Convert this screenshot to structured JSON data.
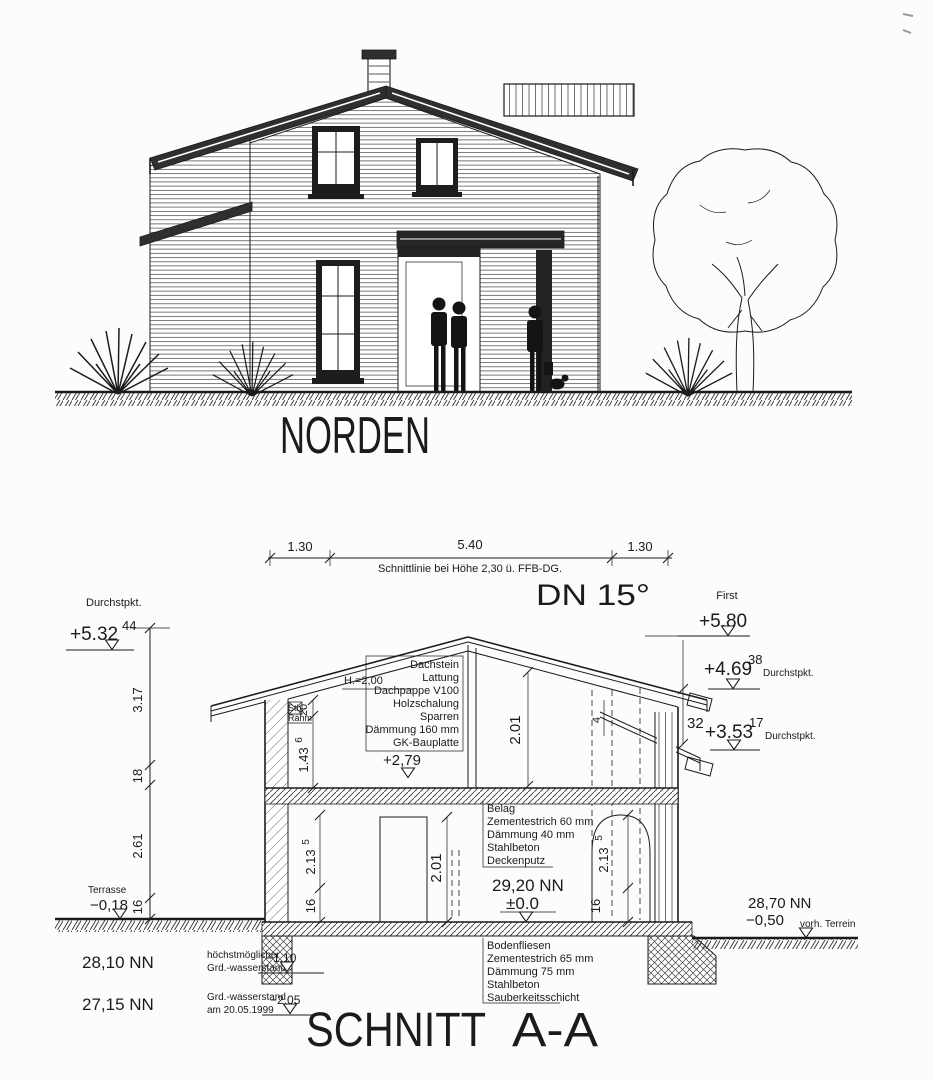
{
  "colors": {
    "ink": "#1b1b1b",
    "paper": "#fcfcfa",
    "roof_dark": "#2f2f2f"
  },
  "elevation": {
    "title": "NORDEN"
  },
  "section": {
    "title_main": "SCHNITT",
    "title_suffix": "A-A",
    "pitch": "DN 15°",
    "top_dims": {
      "left": "1.30",
      "mid": "5.40",
      "right": "1.30",
      "note": "Schnittlinie bei Höhe 2,30 ü. FFB-DG."
    },
    "levels": {
      "left_label": "Durchstpkt.",
      "left_value": "+5.32",
      "left_sup": "44",
      "first_label": "First",
      "first_value": "+5.80",
      "right1_value": "+4.69",
      "right1_sup": "38",
      "right1_label": "Durchstpkt.",
      "right_gap": "32",
      "right2_value": "+3.53",
      "right2_sup": "17",
      "right2_label": "Durchstpkt.",
      "attic": "+2,79",
      "ground_nn": "29,20 NN",
      "ground_rel": "±0.0",
      "terrace_label": "Terrasse",
      "terrace_value": "−0,18",
      "terrain_nn": "28,70 NN",
      "terrain_value": "−0,50",
      "terrain_note": "vorh. Terrein",
      "gw1_nn": "28,10 NN",
      "gw1_line1": "höchstmöglicher",
      "gw1_line2": "Grd.-wasserstand",
      "gw1_value": "−1,10",
      "gw2_nn": "27,15 NN",
      "gw2_line1": "Grd.-wasserstand",
      "gw2_line2": "am 20.05.1999",
      "gw2_value": "−2,05"
    },
    "vdims": {
      "total_upper": "3.17",
      "slab18": "18",
      "ground_floor": "2.61",
      "plinth16": "16",
      "knee_beam": "20",
      "knee_height": "1.43",
      "knee_height_sup": "6",
      "beam_label1": "Stb.-",
      "beam_label2": "Rähm",
      "attic_note": "H.=2,00",
      "attic_height": "2.01",
      "door_height": "2.01",
      "arch_left": "2.13",
      "arch_left_sup": "5",
      "sill_left": "16",
      "arch_right": "2.13",
      "arch_right_sup": "5",
      "sill_right": "16",
      "roof_step": "4"
    },
    "callouts": {
      "roof": [
        "Dachstein",
        "Lattung",
        "Dachpappe V100",
        "Holzschalung",
        "Sparren",
        "Dämmung 160 mm",
        "GK-Bauplatte"
      ],
      "ceiling": [
        "Belag",
        "Zementestrich 60 mm",
        "Dämmung 40 mm",
        "Stahlbeton",
        "Deckenputz"
      ],
      "floor": [
        "Bodenfliesen",
        "Zementestrich 65 mm",
        "Dämmung 75 mm",
        "Stahlbeton",
        "Sauberkeitsschicht"
      ]
    }
  }
}
